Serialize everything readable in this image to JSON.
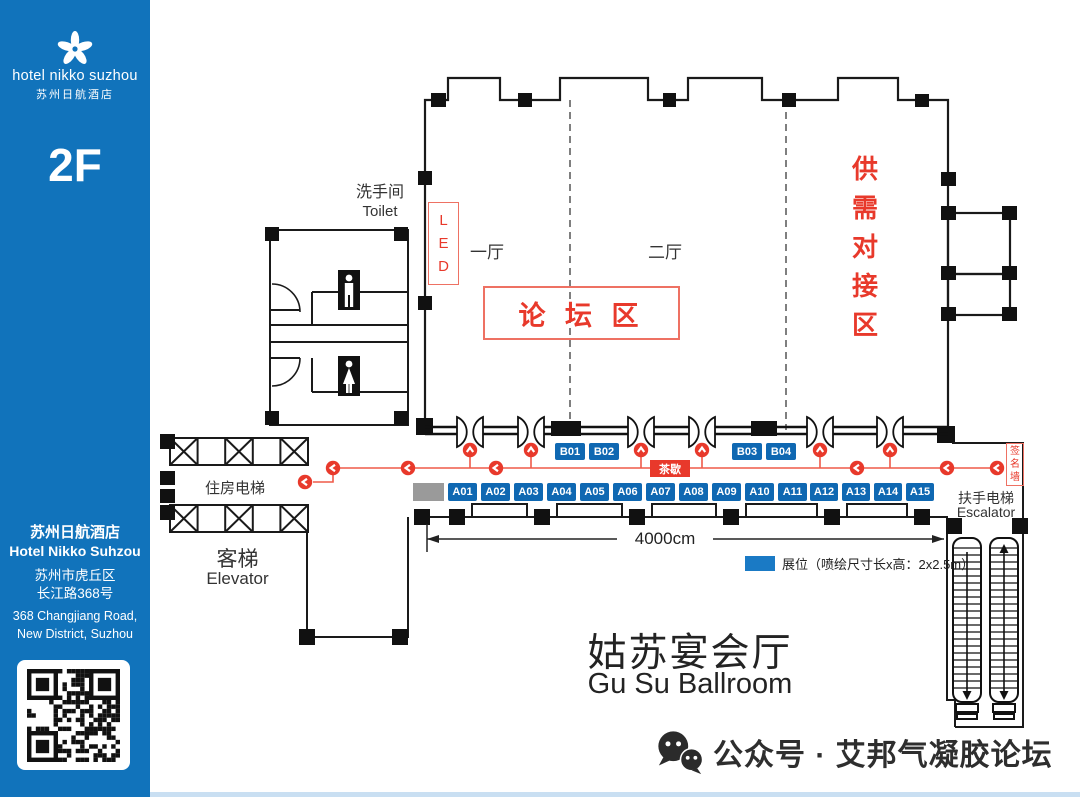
{
  "sidebar": {
    "logo_brand": "hotel nikko suzhou",
    "logo_brand_cn": "苏州日航酒店",
    "floor": "2F",
    "hotel_cn": "苏州日航酒店",
    "hotel_en": "Hotel Nikko Suhzou",
    "addr_cn1": "苏州市虎丘区",
    "addr_cn2": "长江路368号",
    "addr_en1": "368 Changjiang Road,",
    "addr_en2": "New District, Suzhou"
  },
  "plan": {
    "toilet_cn": "洗手间",
    "toilet_en": "Toilet",
    "led": "L\nE\nD",
    "hall_one": "一厅",
    "hall_two": "二厅",
    "forum_zone": "论 坛 区",
    "supply_zone": "供\n需\n对\n接\n区",
    "tea_break": "茶歇",
    "sign_wall": "签\n名\n墙",
    "room_elevator": "住房电梯",
    "guest_elevator_cn": "客梯",
    "guest_elevator_en": "Elevator",
    "escalator_cn": "扶手电梯",
    "escalator_en": "Escalator",
    "dimension": "4000cm",
    "legend_booth": "展位（喷绘尺寸长x高：2x2.5m）",
    "ballroom_cn": "姑苏宴会厅",
    "ballroom_en": "Gu Su Ballroom",
    "b_booths": [
      "B01",
      "B02",
      "B03",
      "B04"
    ],
    "a_booths": [
      "A01",
      "A02",
      "A03",
      "A04",
      "A05",
      "A06",
      "A07",
      "A08",
      "A09",
      "A10",
      "A11",
      "A12",
      "A13",
      "A14",
      "A15"
    ]
  },
  "watermark": {
    "account": "公众号 · 艾邦气凝胶论坛"
  },
  "colors": {
    "sidebar_blue": "#1173bb",
    "booth_blue": "#0f68b2",
    "accent_red": "#e8392b"
  }
}
